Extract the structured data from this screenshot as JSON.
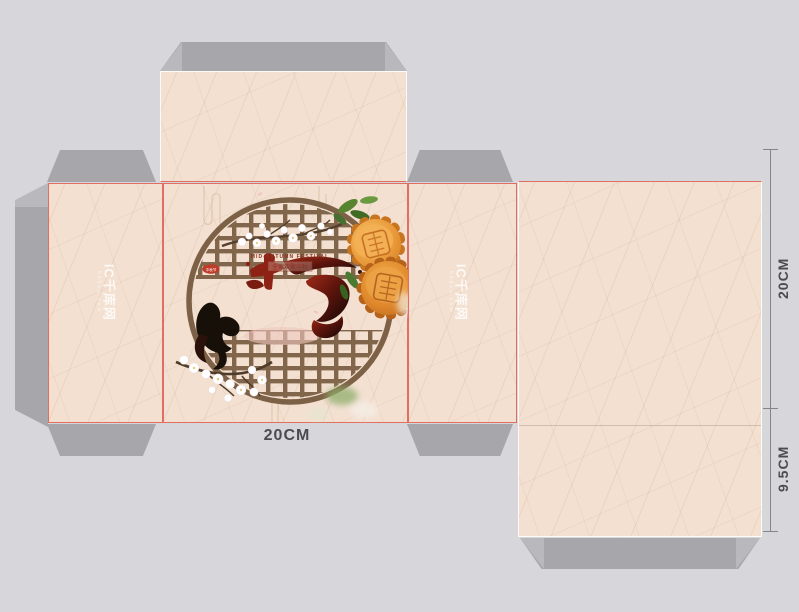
{
  "page": {
    "kind": "mooncake packaging box dieline mockup"
  },
  "dimensions": {
    "width_bottom": "20CM",
    "height_right": "20CM",
    "depth_right": "9.5CM"
  },
  "watermark": {
    "brand": "IC千库网",
    "sub": "588ku.com"
  },
  "artwork": {
    "badge_label": "中秋节",
    "tagline_en": "MID-AUTUMN FESTIVAL",
    "tagline_cn": "全家欢聚中秋",
    "calligraphy": "中秋"
  },
  "colors": {
    "paper": "#f3e0d1",
    "flap_gray": "#a7a6ab",
    "background": "#d7d6da",
    "cut_line": "#dd6257",
    "lattice_brown": "#7d6146",
    "mooncake_orange": "#e48f35",
    "ink_red": "#8e2214"
  }
}
